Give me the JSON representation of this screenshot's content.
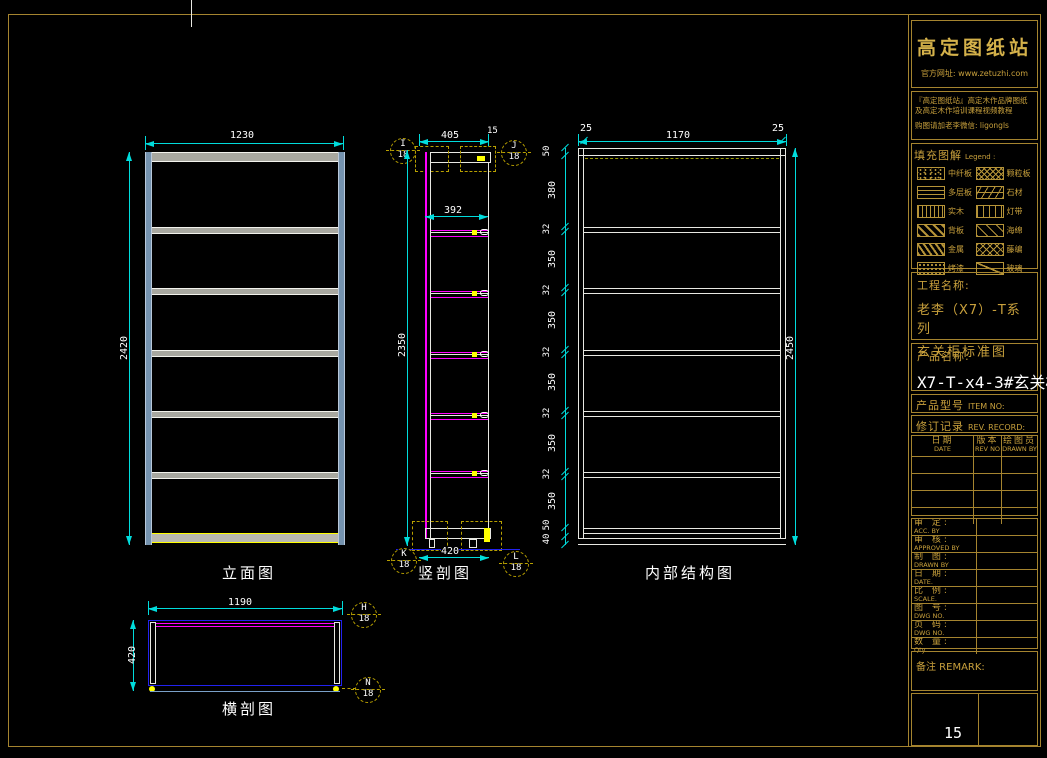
{
  "colors": {
    "background": "#000000",
    "border_gold": "#a5842f",
    "dimension_cyan": "#00dcdc",
    "text_white": "#ffffff",
    "panel_blue": "#7492ae",
    "shelf_magenta": "#ff00ff",
    "accent_yellow": "#ffff00",
    "outline_blue": "#2222ee",
    "title_gold": "#c8a03c"
  },
  "views": {
    "elevation": {
      "label": "立面图",
      "dim_width": "1230",
      "dim_height": "2420"
    },
    "section": {
      "label": "竖剖图",
      "dim_top": "405",
      "dim_top_small": "15",
      "dim_inner": "392",
      "dim_height": "2350",
      "dim_bottom": "420",
      "balloons": [
        {
          "letter": "I",
          "num": "18"
        },
        {
          "letter": "J",
          "num": "18"
        },
        {
          "letter": "K",
          "num": "18"
        },
        {
          "letter": "L",
          "num": "18"
        }
      ]
    },
    "internal": {
      "label": "内部结构图",
      "dim_left": "25",
      "dim_center": "1170",
      "dim_right": "25",
      "dim_height": "2450",
      "chain": [
        "50",
        "380",
        "32",
        "350",
        "32",
        "350",
        "32",
        "350",
        "32",
        "350",
        "32",
        "350",
        "50",
        "40"
      ]
    },
    "plan": {
      "label": "横剖图",
      "dim_width": "1190",
      "dim_height": "420",
      "balloons": [
        {
          "letter": "H",
          "num": "18"
        },
        {
          "letter": "N",
          "num": "18"
        }
      ]
    }
  },
  "titleblock": {
    "logo": "高定图纸站",
    "website": "官方网址: www.zetuzhi.com",
    "promo_line1": "『高定图纸站』高定木作品牌图纸",
    "promo_line2": "及高定木作培训课程视频教程",
    "promo_line3": "购图请加老李微信: ligongls",
    "legend_title": "填充图解",
    "legend_en": "Legend :",
    "legend_items": [
      {
        "label": "中纤板",
        "pattern": "speckle"
      },
      {
        "label": "颗粒板",
        "pattern": "net"
      },
      {
        "label": "多层板",
        "pattern": "hdash"
      },
      {
        "label": "石材",
        "pattern": "brick"
      },
      {
        "label": "实木",
        "pattern": "grain"
      },
      {
        "label": "灯带",
        "pattern": "vdash"
      },
      {
        "label": "背板",
        "pattern": "hatch"
      },
      {
        "label": "海绵",
        "pattern": "scatter"
      },
      {
        "label": "金属",
        "pattern": "hatch2"
      },
      {
        "label": "藤编",
        "pattern": "mesh"
      },
      {
        "label": "烤漆",
        "pattern": "dots"
      },
      {
        "label": "玻璃",
        "pattern": "slash"
      }
    ],
    "project_label": "工程名称:",
    "project_line1": "老李（X7）-T系列",
    "project_line2": "玄关柜标准图",
    "product_label": "产品名称:",
    "product_value": "X7-T-x4-3#玄关柜",
    "item_no_cn": "产品型号",
    "item_no_en": "ITEM NO:",
    "rev_record_cn": "修订记录",
    "rev_record_en": "REV. RECORD:",
    "rev_headers": [
      {
        "cn": "日期",
        "en": "DATE"
      },
      {
        "cn": "版本",
        "en": "REV NO"
      },
      {
        "cn": "绘图员",
        "en": "DRAWN BY"
      }
    ],
    "rev_empty_rows": 4,
    "info_rows": [
      {
        "cn": "审 定:",
        "en": "ACC. BY"
      },
      {
        "cn": "审 核:",
        "en": "APPROVED BY"
      },
      {
        "cn": "制 图:",
        "en": "DRAWN BY"
      },
      {
        "cn": "日 期:",
        "en": "DATE."
      },
      {
        "cn": "比 例:",
        "en": "SCALE."
      },
      {
        "cn": "图 号:",
        "en": "DWG NO."
      },
      {
        "cn": "页 码:",
        "en": "DWG NO."
      },
      {
        "cn": "数 量:",
        "en": "Qty."
      }
    ],
    "remark": "备注 REMARK:",
    "page_number": "15"
  }
}
